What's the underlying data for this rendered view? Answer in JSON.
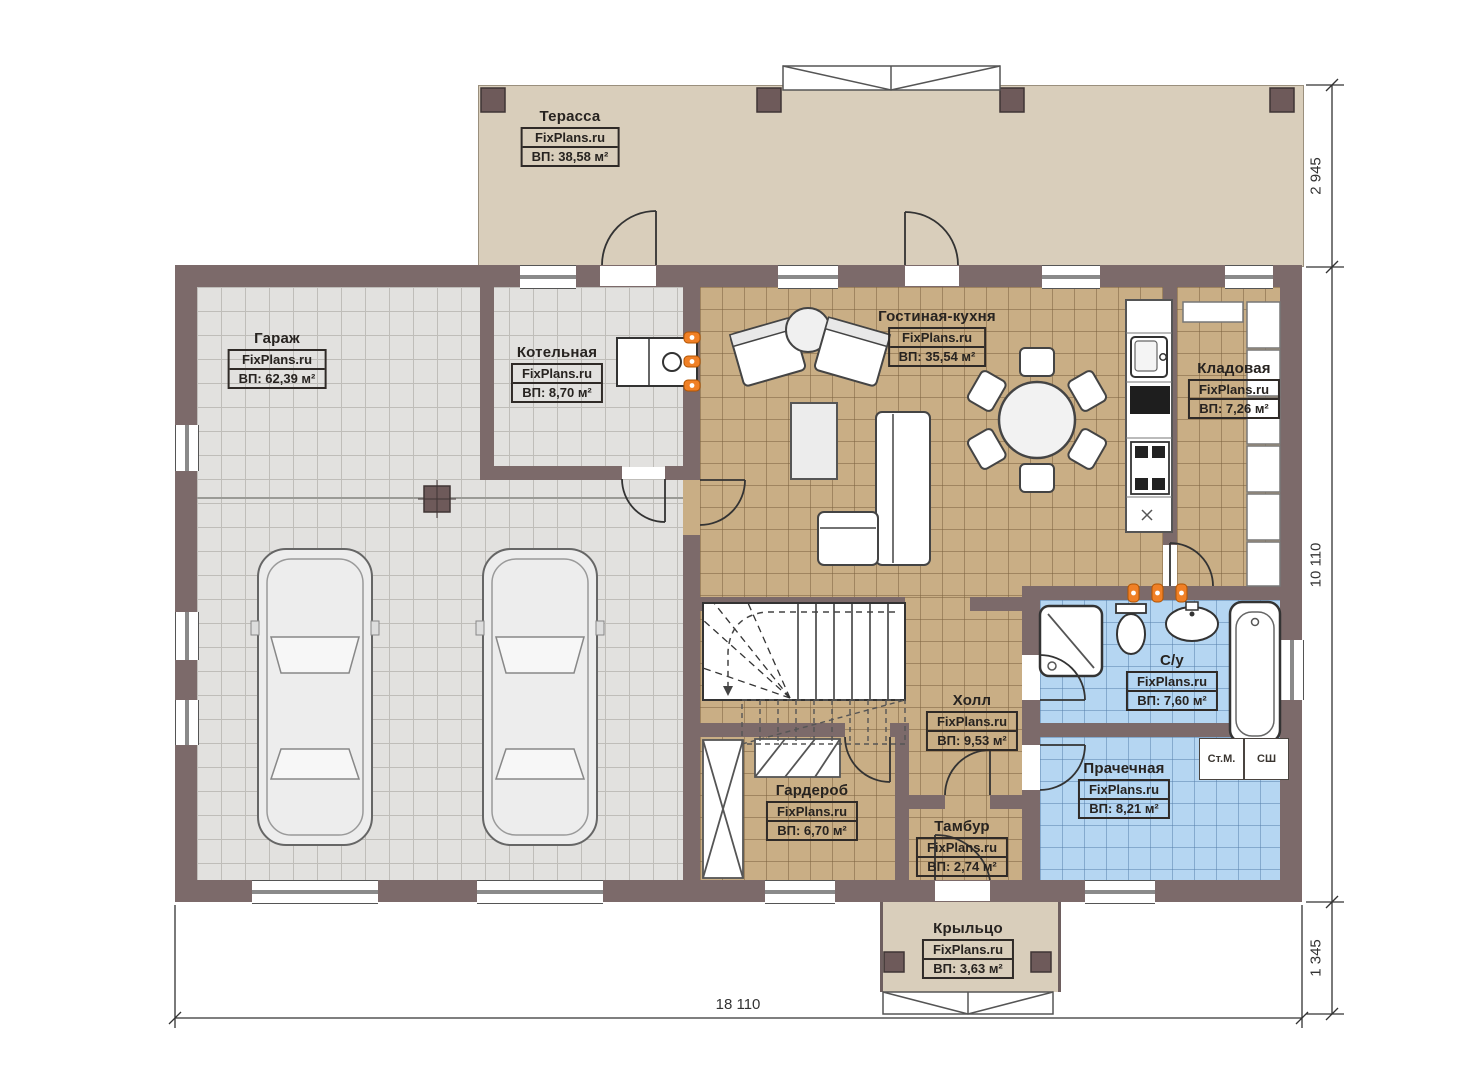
{
  "brand": "FixPlans.ru",
  "rooms": {
    "terrace": {
      "title": "Терасса",
      "site": "FixPlans.ru",
      "area": "ВП: 38,58 м²"
    },
    "garage": {
      "title": "Гараж",
      "site": "FixPlans.ru",
      "area": "ВП: 62,39 м²"
    },
    "boiler": {
      "title": "Котельная",
      "site": "FixPlans.ru",
      "area": "ВП: 8,70 м²"
    },
    "living": {
      "title": "Гостиная-кухня",
      "site": "FixPlans.ru",
      "area": "ВП: 35,54 м²"
    },
    "storage": {
      "title": "Кладовая",
      "site": "FixPlans.ru",
      "area": "ВП: 7,26 м²"
    },
    "bathroom": {
      "title": "С/у",
      "site": "FixPlans.ru",
      "area": "ВП: 7,60 м²"
    },
    "hall": {
      "title": "Холл",
      "site": "FixPlans.ru",
      "area": "ВП: 9,53 м²"
    },
    "wardrobe": {
      "title": "Гардероб",
      "site": "FixPlans.ru",
      "area": "ВП: 6,70 м²"
    },
    "vestibule": {
      "title": "Тамбур",
      "site": "FixPlans.ru",
      "area": "ВП: 2,74 м²"
    },
    "laundry": {
      "title": "Прачечная",
      "site": "FixPlans.ru",
      "area": "ВП: 8,21 м²"
    },
    "porch": {
      "title": "Крыльцо",
      "site": "FixPlans.ru",
      "area": "ВП: 3,63 м²"
    }
  },
  "appliances": {
    "washer": "Ст.М.",
    "dryer": "СШ"
  },
  "dimensions": {
    "terrace_depth": "2 945",
    "house_depth": "10 110",
    "porch_depth": "1 345",
    "total_width": "18 110"
  },
  "colors": {
    "wall": "#7c6a6a",
    "terrace": "#d9cebb",
    "tan": "#c9ae85",
    "blue": "#b5d6f2",
    "gray": "#e2e1df",
    "radiator": "#f08026"
  }
}
